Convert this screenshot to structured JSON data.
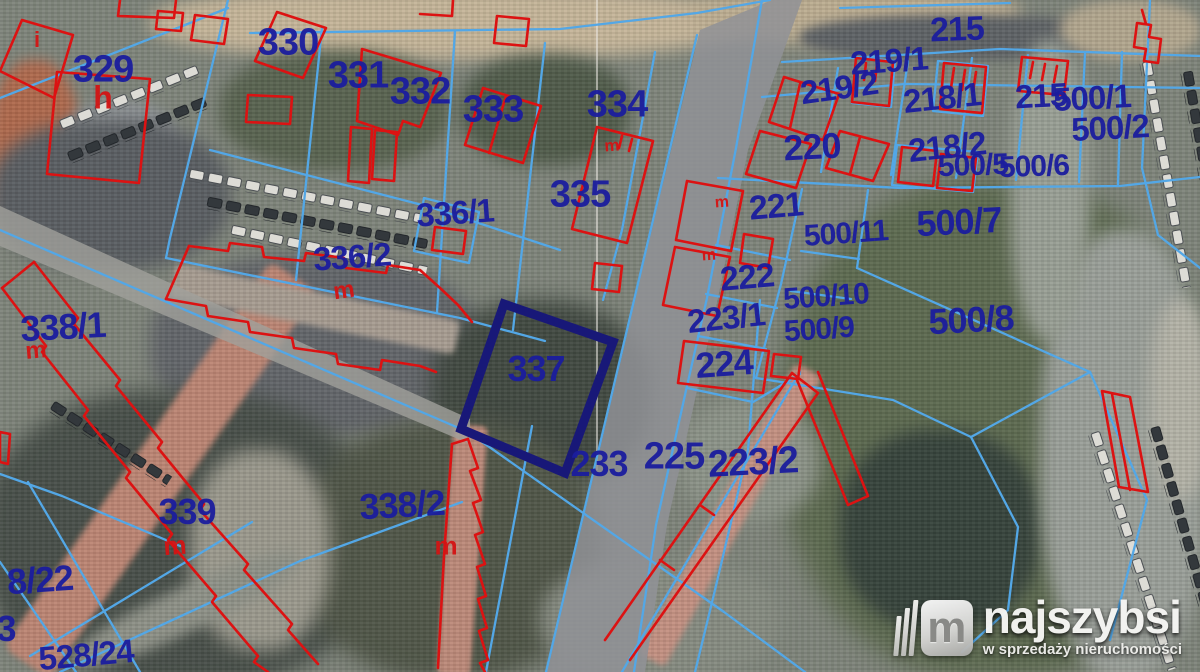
{
  "map": {
    "type": "cadastral-parcel-map-over-satellite",
    "highlighted_parcel": "337",
    "colors": {
      "boundary_blue": "#53a7e6",
      "building_red": "#dc1212",
      "highlight_navy": "#181878",
      "parcel_label_blue": "#1b1d9e",
      "building_label_red": "#d41414"
    },
    "parcel_labels": [
      {
        "t": "329",
        "x": 103,
        "y": 70,
        "s": 38,
        "r": 0
      },
      {
        "t": "330",
        "x": 288,
        "y": 43,
        "s": 38,
        "r": 0
      },
      {
        "t": "331",
        "x": 358,
        "y": 76,
        "s": 38,
        "r": 0
      },
      {
        "t": "332",
        "x": 420,
        "y": 92,
        "s": 38,
        "r": 0
      },
      {
        "t": "333",
        "x": 493,
        "y": 110,
        "s": 38,
        "r": 0
      },
      {
        "t": "334",
        "x": 617,
        "y": 105,
        "s": 38,
        "r": 0
      },
      {
        "t": "335",
        "x": 580,
        "y": 195,
        "s": 38,
        "r": 0
      },
      {
        "t": "336/1",
        "x": 455,
        "y": 213,
        "s": 33,
        "r": -4
      },
      {
        "t": "336/2",
        "x": 352,
        "y": 257,
        "s": 33,
        "r": -4
      },
      {
        "t": "337",
        "x": 536,
        "y": 369,
        "s": 36,
        "r": 0
      },
      {
        "t": "338/1",
        "x": 63,
        "y": 327,
        "s": 36,
        "r": -3
      },
      {
        "t": "338/2",
        "x": 402,
        "y": 505,
        "s": 36,
        "r": -3
      },
      {
        "t": "339",
        "x": 187,
        "y": 512,
        "s": 36,
        "r": 0
      },
      {
        "t": "233",
        "x": 599,
        "y": 464,
        "s": 36,
        "r": 0
      },
      {
        "t": "225",
        "x": 674,
        "y": 457,
        "s": 38,
        "r": 0
      },
      {
        "t": "223/2",
        "x": 753,
        "y": 463,
        "s": 38,
        "r": -3
      },
      {
        "t": "224",
        "x": 724,
        "y": 364,
        "s": 36,
        "r": -4
      },
      {
        "t": "223/1",
        "x": 726,
        "y": 318,
        "s": 33,
        "r": -6
      },
      {
        "t": "221",
        "x": 776,
        "y": 207,
        "s": 34,
        "r": -5
      },
      {
        "t": "222",
        "x": 747,
        "y": 278,
        "s": 34,
        "r": -5
      },
      {
        "t": "500/11",
        "x": 846,
        "y": 234,
        "s": 30,
        "r": -4
      },
      {
        "t": "500/10",
        "x": 826,
        "y": 297,
        "s": 30,
        "r": -4
      },
      {
        "t": "500/9",
        "x": 819,
        "y": 330,
        "s": 30,
        "r": -4
      },
      {
        "t": "500/8",
        "x": 971,
        "y": 320,
        "s": 36,
        "r": -3
      },
      {
        "t": "500/7",
        "x": 959,
        "y": 222,
        "s": 36,
        "r": -3
      },
      {
        "t": "215",
        "x": 957,
        "y": 30,
        "s": 34,
        "r": -2
      },
      {
        "t": "219/1",
        "x": 889,
        "y": 61,
        "s": 33,
        "r": -4
      },
      {
        "t": "219/2",
        "x": 839,
        "y": 88,
        "s": 33,
        "r": -8
      },
      {
        "t": "218/1",
        "x": 942,
        "y": 98,
        "s": 33,
        "r": -6
      },
      {
        "t": "220",
        "x": 812,
        "y": 147,
        "s": 36,
        "r": -3
      },
      {
        "t": "218/2",
        "x": 947,
        "y": 147,
        "s": 33,
        "r": -6
      },
      {
        "t": "215",
        "x": 1041,
        "y": 96,
        "s": 33,
        "r": -3
      },
      {
        "t": "500/1",
        "x": 1092,
        "y": 98,
        "s": 33,
        "r": -3
      },
      {
        "t": "500/2",
        "x": 1110,
        "y": 128,
        "s": 33,
        "r": -3
      },
      {
        "t": "500/5",
        "x": 973,
        "y": 166,
        "s": 30,
        "r": -2
      },
      {
        "t": "500/6",
        "x": 1034,
        "y": 167,
        "s": 30,
        "r": -2
      },
      {
        "t": "8/22",
        "x": 40,
        "y": 580,
        "s": 36,
        "r": -4
      },
      {
        "t": "3",
        "x": 6,
        "y": 629,
        "s": 36,
        "r": 0
      },
      {
        "t": "528/24",
        "x": 86,
        "y": 655,
        "s": 33,
        "r": -5
      }
    ],
    "building_labels": [
      {
        "t": "h",
        "x": 103,
        "y": 98,
        "s": 32,
        "r": 0
      },
      {
        "t": "i",
        "x": 37,
        "y": 40,
        "s": 22,
        "r": 0
      },
      {
        "t": "m",
        "x": 36,
        "y": 351,
        "s": 24,
        "r": -5
      },
      {
        "t": "m",
        "x": 344,
        "y": 291,
        "s": 24,
        "r": -8
      },
      {
        "t": "m",
        "x": 175,
        "y": 546,
        "s": 26,
        "r": -4
      },
      {
        "t": "m",
        "x": 446,
        "y": 546,
        "s": 26,
        "r": 0
      },
      {
        "t": "m",
        "x": 612,
        "y": 146,
        "s": 17,
        "r": -4
      },
      {
        "t": "m",
        "x": 722,
        "y": 203,
        "s": 16,
        "r": -4
      },
      {
        "t": "m",
        "x": 709,
        "y": 256,
        "s": 16,
        "r": -4
      }
    ]
  },
  "watermark": {
    "logo_letter": "m",
    "brand": "najszybsi",
    "tagline": "w sprzedaży nieruchomości"
  }
}
